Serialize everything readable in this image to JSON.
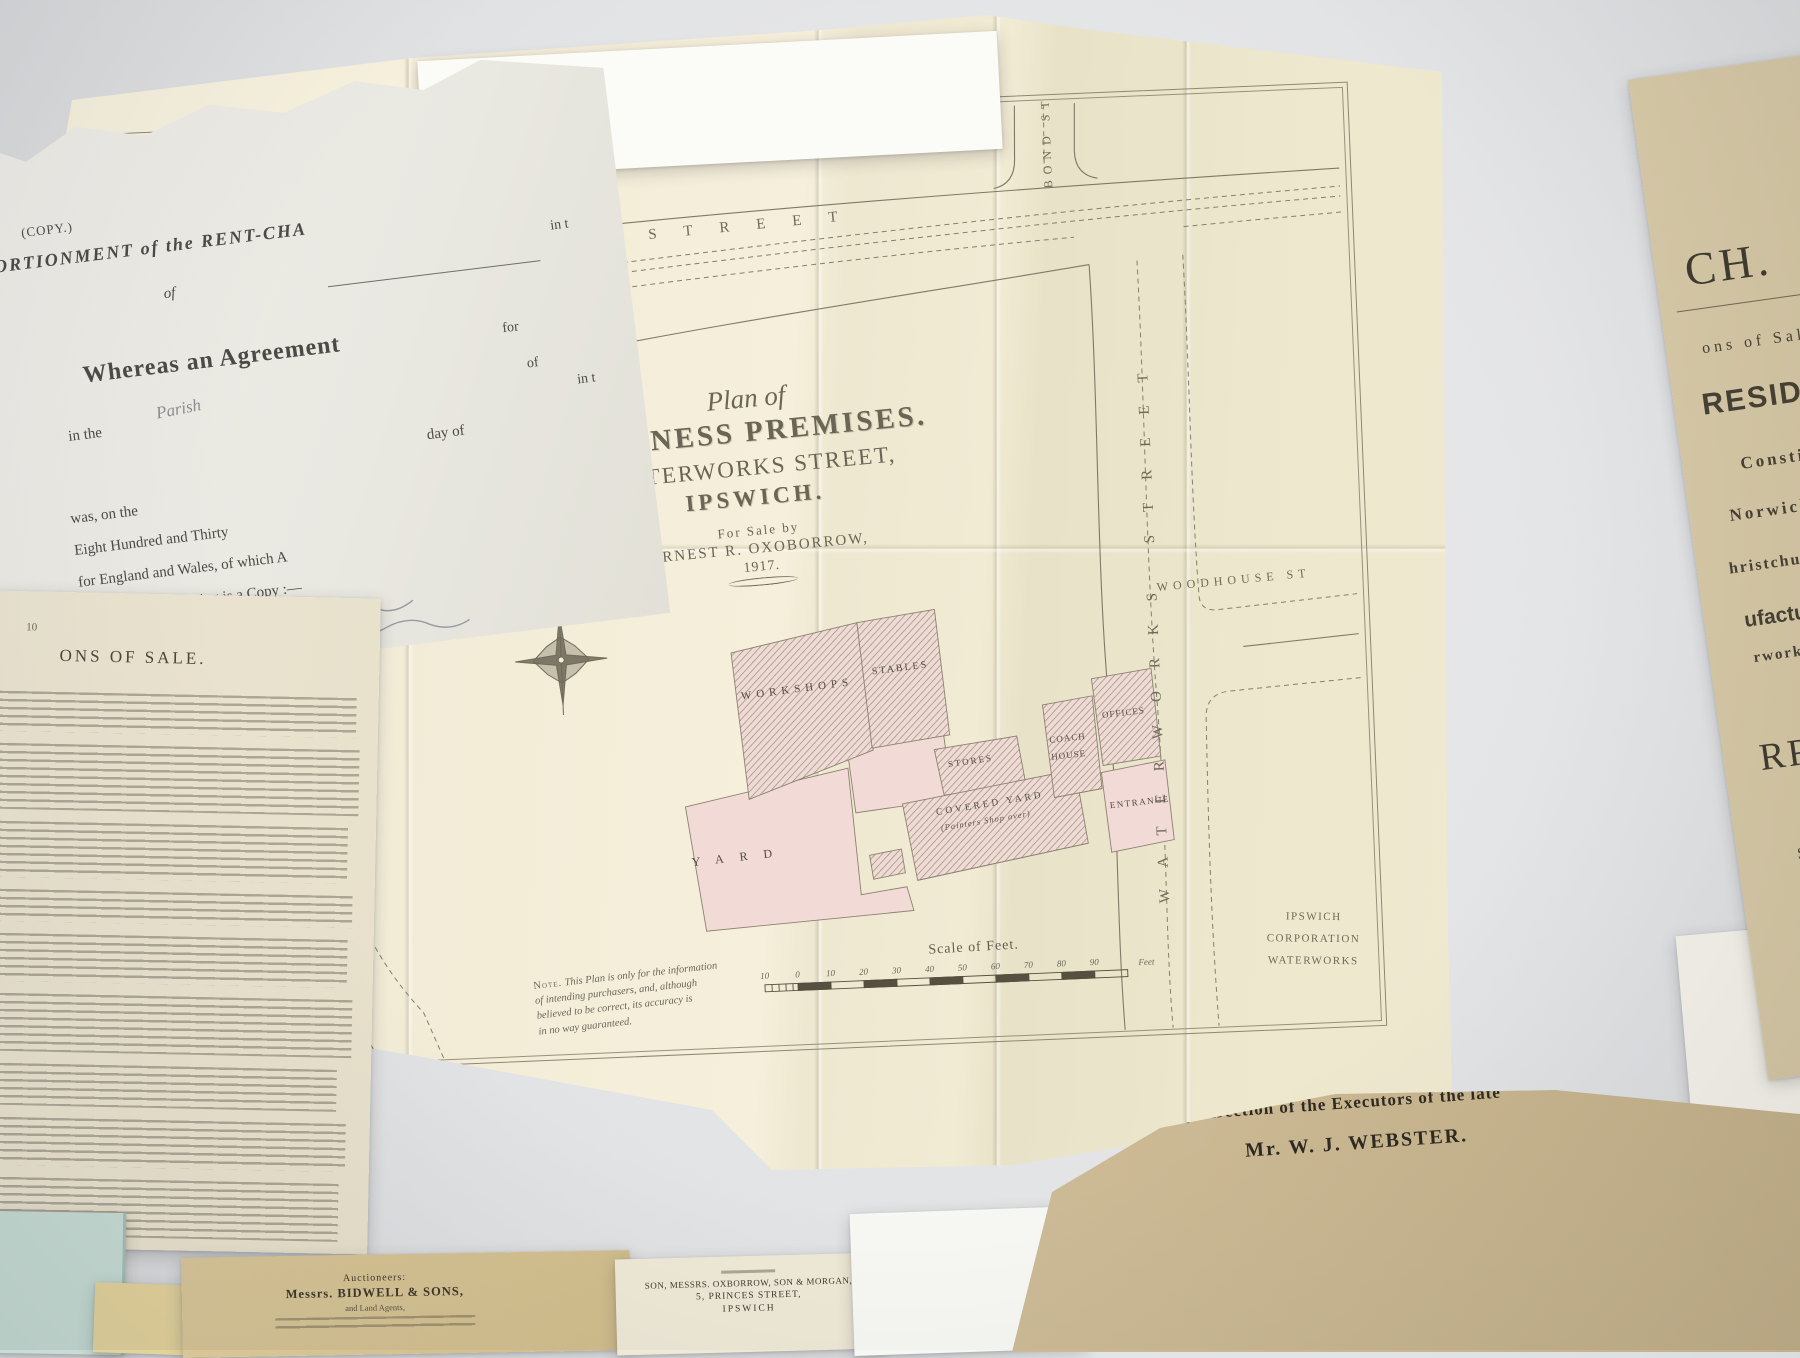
{
  "palette": {
    "plan_paper": "#f4eeda",
    "pink_wash": "#f2dad7",
    "hatch_brown": "#b5918a",
    "ink": "#6f6b59",
    "tan_paper": "#d2c4a1",
    "manila_paper": "#c9b692",
    "teal_paper": "#c6dcd4"
  },
  "plan": {
    "title": {
      "script": "Plan of",
      "line1": "BUSINESS PREMISES.",
      "line2": "WATERWORKS STREET,",
      "line3": "IPSWICH.",
      "for_sale": "For Sale by",
      "agent": "ERNEST R. OXOBORROW,",
      "year": "1917."
    },
    "streets": {
      "eagle": "EAGLE STREET",
      "orwell_place": "ORWELL PLACE",
      "upper_orwell": [
        "UPPER",
        "ORWELL",
        "STREET"
      ],
      "tramway": "Tramway to Cornhill",
      "fore": "FORE STREET",
      "lower_orwell": "LOWER ORWELL ST.",
      "bond": "BOND ST",
      "waterworks": "WATERWORKS STREET",
      "woodhouse": "WOODHOUSE ST"
    },
    "buildings": {
      "workshops": "WORKSHOPS",
      "stables": "STABLES",
      "yard": "YARD",
      "stores": "STORES",
      "covered_yard": "COVERED YARD",
      "painters": "(Painters Shop over)",
      "coach1": "COACH",
      "coach2": "HOUSE",
      "offices": "OFFICES",
      "entrance": "ENTRANCE"
    },
    "waterworks_corp": [
      "IPSWICH",
      "CORPORATION",
      "WATERWORKS"
    ],
    "scale": {
      "title": "Scale of Feet.",
      "ticks": [
        "10",
        "0",
        "10",
        "20",
        "30",
        "40",
        "50",
        "60",
        "70",
        "80",
        "90"
      ],
      "unit": "Feet"
    },
    "note": {
      "label": "Note.",
      "lines": [
        "This Plan is only for the information",
        "of intending purchasers, and, although",
        "believed to be correct, its accuracy is",
        "in no way guaranteed."
      ]
    }
  },
  "apportionment": {
    "copy": "(COPY.)",
    "heading": "PORTIONMENT of the RENT-CHA",
    "frag_in": "in t",
    "of": "of",
    "whereas": "Whereas an Agreement",
    "frag_for": "for",
    "frag_of": "of",
    "in_the": "in the",
    "parish": "Parish",
    "frag_in2": "in t",
    "day_of": "day of",
    "was": "was, on the",
    "thirty": "Eight Hundred and Thirty",
    "england": "for England and Wales, of which A",
    "annexed": "annexed, the following is a Copy :—"
  },
  "conditions": {
    "page": "10",
    "heading": "ONS  OF  SALE."
  },
  "sale_particulars": {
    "big_frag": "CH.",
    "sale_line": "ons  of  Sale",
    "residence": "RESIDENC",
    "line1": "Constitution H",
    "line2": "Norwich  Road",
    "line3": "hristchurch  St",
    "manufacturer": "ufacturer",
    "line4": "rworks  Street",
    "name_frag": "RROW",
    "town": "SWICH,",
    "date_frag": "0th,  19",
    "small1": "deceased,",
    "small2": "& STEWARD,  M"
  },
  "executors": {
    "line1": "By  direction  of  the  Executors  of  the  late",
    "line2": "Mr.  W.  J.  WEBSTER."
  },
  "bidwell": {
    "label": "Auctioneers:",
    "name": "Messrs. BIDWELL & SONS,",
    "sub": "and Land Agents,"
  },
  "princes": {
    "name": "SON, MESSRS. OXBORROW, SON & MORGAN,",
    "street": "5, PRINCES STREET,",
    "town": "IPSWICH"
  }
}
